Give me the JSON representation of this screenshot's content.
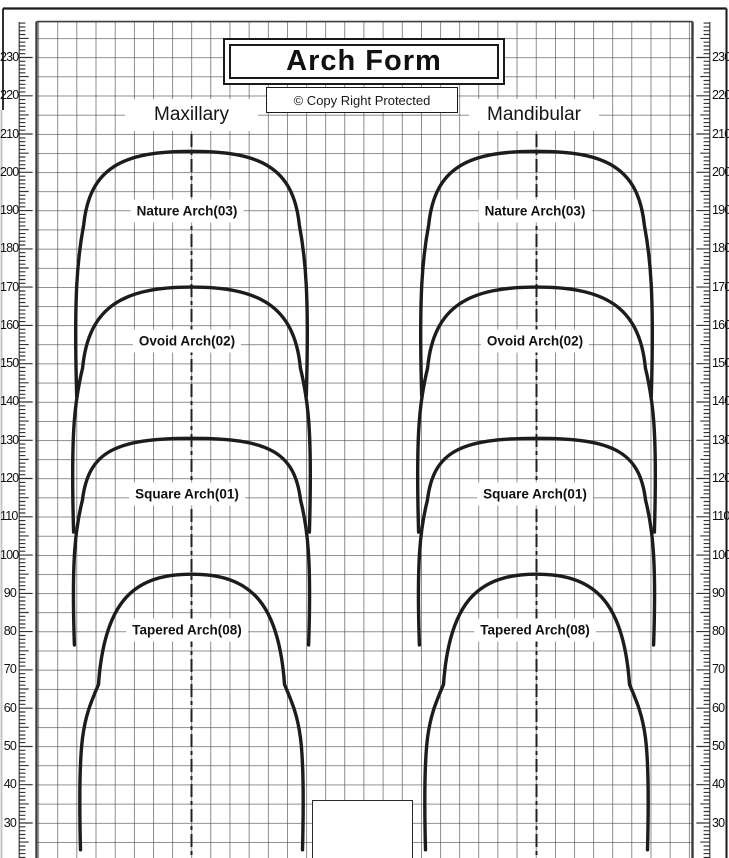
{
  "page": {
    "title": "Arch Form",
    "copyright": "© Copy Right Protected"
  },
  "panels": [
    {
      "header": "Maxillary"
    },
    {
      "header": "Mandibular"
    }
  ],
  "chart_data": {
    "type": "line",
    "title": "Arch Form",
    "subtitle": "© Copy Right Protected",
    "panel_names": [
      "Maxillary",
      "Mandibular"
    ],
    "y_axis": {
      "side": "both",
      "min_label": 30,
      "max_label": 230,
      "major_step": 10,
      "minor_step": 1,
      "labels": [
        230,
        220,
        210,
        200,
        190,
        180,
        170,
        160,
        150,
        140,
        130,
        120,
        110,
        100,
        90,
        80,
        70,
        60,
        50,
        40,
        30
      ]
    },
    "grid": {
      "on": true,
      "units_per_square": 5
    },
    "arches": [
      {
        "label": "Nature Arch(03)",
        "code": "03",
        "shape": "nature",
        "apex_scale": 205.5,
        "leg_end_scale": 141.5,
        "half_width_scale": 30.0,
        "label_scale": 190
      },
      {
        "label": "Ovoid Arch(02)",
        "code": "02",
        "shape": "ovoid",
        "apex_scale": 170.0,
        "leg_end_scale": 106.0,
        "half_width_scale": 30.8,
        "label_scale": 156
      },
      {
        "label": "Square Arch(01)",
        "code": "01",
        "shape": "square",
        "apex_scale": 130.5,
        "leg_end_scale": 76.5,
        "half_width_scale": 30.6,
        "label_scale": 116
      },
      {
        "label": "Tapered Arch(08)",
        "code": "08",
        "shape": "tapered",
        "apex_scale": 95.0,
        "leg_end_scale": 23.0,
        "half_width_scale": 29.0,
        "label_scale": 80.5
      }
    ],
    "colors": {
      "curve": "#1c1c1c",
      "grid": "#4a4a4a",
      "frame": "#1a1a1a"
    }
  }
}
